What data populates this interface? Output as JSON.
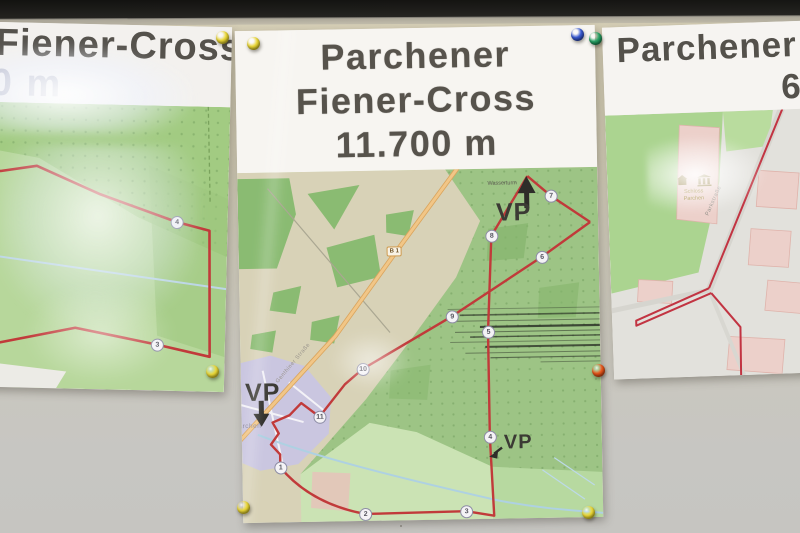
{
  "scene": {
    "description": "Photo of three laminated cross-country course maps pinned to a wall board",
    "route_color": "#c13a3a",
    "wall_color": "#cfc9b4",
    "board_edge_color": "#151310"
  },
  "posters": {
    "left": {
      "title": "Fiener-Cross",
      "subtitle": "0 m",
      "waypoints": [
        {
          "label": "4",
          "x": 229,
          "y": 116
        },
        {
          "label": "3",
          "x": 212,
          "y": 239
        }
      ]
    },
    "center": {
      "title_line1": "Parchener",
      "title_line2": "Fiener-Cross",
      "title_line3": "11.700 m",
      "vp_label": "VP",
      "road_badge": "B 1",
      "street_label": "Genthiner Straße",
      "village_label": "Parchen",
      "map_label": "Wasserturm",
      "waypoints": [
        {
          "label": "1",
          "x": 38,
          "y": 295
        },
        {
          "label": "2",
          "x": 122,
          "y": 343
        },
        {
          "label": "3",
          "x": 223,
          "y": 342
        },
        {
          "label": "4",
          "x": 248,
          "y": 268
        },
        {
          "label": "5",
          "x": 248,
          "y": 163
        },
        {
          "label": "6",
          "x": 303,
          "y": 89
        },
        {
          "label": "7",
          "x": 313,
          "y": 28
        },
        {
          "label": "8",
          "x": 253,
          "y": 67
        },
        {
          "label": "9",
          "x": 212,
          "y": 147
        },
        {
          "label": "10",
          "x": 122,
          "y": 198
        },
        {
          "label": "11",
          "x": 78,
          "y": 245
        }
      ]
    },
    "right": {
      "title_line1": "Parchener",
      "title_line2": "60",
      "place_line1": "Schloss",
      "place_line2": "Parchen",
      "street_label": "Parkstraße"
    }
  },
  "pins": [
    {
      "name": "yellow-pushpin-left-poster-top",
      "color": "#ead738",
      "shade": "#a39514",
      "x": 222,
      "y": 37
    },
    {
      "name": "yellow-pushpin-center-poster-top",
      "color": "#ead738",
      "shade": "#a39514",
      "x": 253,
      "y": 43
    },
    {
      "name": "blue-pushpin",
      "color": "#3a5bd2",
      "shade": "#1b2e7e",
      "x": 577,
      "y": 34
    },
    {
      "name": "green-pushpin",
      "color": "#27a265",
      "shade": "#0e5c36",
      "x": 595,
      "y": 38
    },
    {
      "name": "yellow-pushpin-left-poster-bottom",
      "color": "#ead738",
      "shade": "#a39514",
      "x": 212,
      "y": 371
    },
    {
      "name": "orange-pushpin",
      "color": "#e8571c",
      "shade": "#96300a",
      "x": 598,
      "y": 370
    },
    {
      "name": "yellow-pushpin-center-bottom-left",
      "color": "#ead738",
      "shade": "#a39514",
      "x": 243,
      "y": 507
    },
    {
      "name": "yellow-pushpin-center-bottom-right",
      "color": "#ead738",
      "shade": "#a39514",
      "x": 588,
      "y": 512
    }
  ]
}
